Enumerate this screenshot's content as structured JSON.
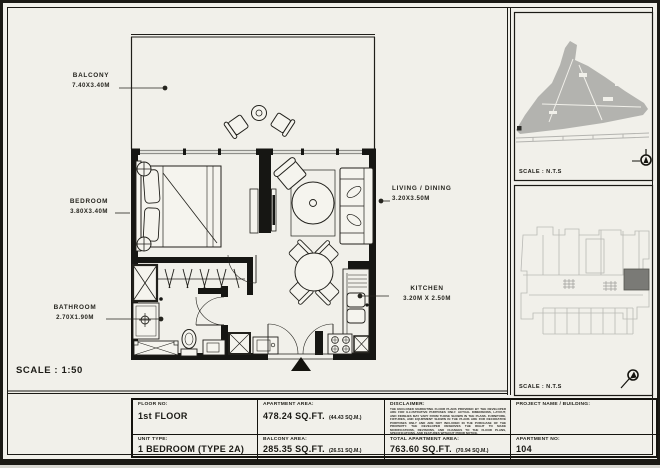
{
  "colors": {
    "paper": "#f1f0ea",
    "line": "#1b1a15",
    "wall": "#161613",
    "glass": "#8f8f8a",
    "map_gray": "#b3b3af",
    "unit_highlight": "#7a7a76"
  },
  "plan": {
    "scale_label": "SCALE : 1:50",
    "rooms": [
      {
        "name": "BALCONY",
        "dims": "7.40X3.40M"
      },
      {
        "name": "BEDROOM",
        "dims": "3.80X3.40M"
      },
      {
        "name": "BATHROOM",
        "dims": "2.70X1.90M"
      },
      {
        "name": "LIVING / DINING",
        "dims": "3.20X3.50M"
      },
      {
        "name": "KITCHEN",
        "dims": "3.20M X 2.50M"
      }
    ]
  },
  "sidebar": {
    "site_plan_scale": "SCALE : N.T.S",
    "key_plan_scale": "SCALE : N.T.S"
  },
  "table": {
    "floor_no_label": "FLOOR NO:",
    "floor_no": "1st FLOOR",
    "unit_type_label": "UNIT TYPE:",
    "unit_type": "1 BEDROOM (TYPE 2A)",
    "apartment_area_label": "APARTMENT AREA:",
    "apartment_area": "478.24 SQ.FT.",
    "apartment_area_metric": "(44.43 SQ.M.)",
    "balcony_area_label": "BALCONY AREA:",
    "balcony_area": "285.35 SQ.FT.",
    "balcony_area_metric": "(26.51 SQ.M.)",
    "disclaimer_label": "DISCLAIMER:",
    "disclaimer_text": "THE ENCLOSED MARKETING FLOOR PLANS PROVIDED BY THE DEVELOPER ARE FOR ILLUSTRATIVE PURPOSES ONLY. ACTUAL DIMENSIONS, LAYOUT, AND FINISHES MAY VARY FROM THOSE SHOWN IN THE PLANS. FURNITURE, FIXTURES, AND EQUIPMENT SHOWN IN THE PLANS ARE FOR DECORATIVE PURPOSES ONLY AND ARE NOT INCLUDED IN THE PURCHASE OF THE PROPERTY. THE DEVELOPER RESERVES THE RIGHT TO MAKE MODIFICATIONS, REVISIONS, AND CHANGES TO THE FLOOR PLANS, SPECIFICATIONS, AND FEATURES WITHOUT PRIOR NOTICE.",
    "total_area_label": "TOTAL APARTMENT AREA:",
    "total_area": "763.60 SQ.FT.",
    "total_area_metric": "(70.94 SQ.M.)",
    "project_label": "PROJECT NAME / BUILDING:",
    "project_value": "",
    "apartment_no_label": "APARTMENT NO:",
    "apartment_no": "104"
  }
}
